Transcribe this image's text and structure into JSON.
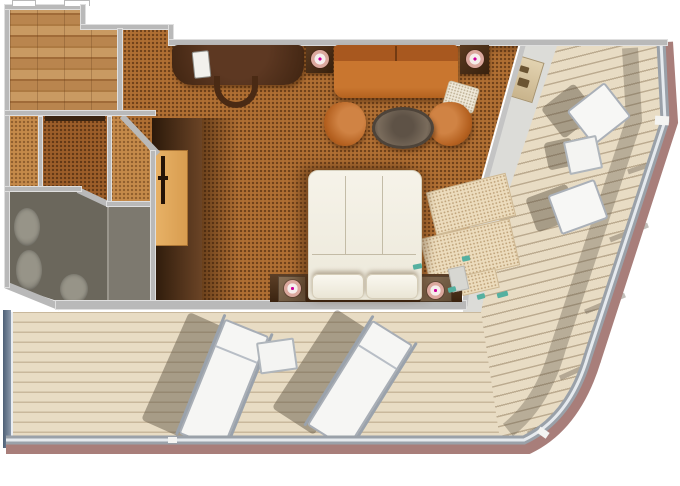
{
  "meta": {
    "kind": "cruise-ship-suite-floor-plan",
    "view": "top-down",
    "text_labels": []
  },
  "palette": {
    "bg": "#ffffff",
    "wall": "#b9b9b9",
    "carpet": "#b06f33",
    "carpet-light": "#c58a4a",
    "carpet-mid": "#9c5e29",
    "bath": "#6b675c",
    "bath-light": "#7d796f",
    "deck-plank": "#e8dcc4",
    "deck-line": "#c9b89c",
    "deck-line2": "#bcab90",
    "walkway": "#dcdcd8",
    "hull-dark": "#4e6076",
    "hull-light": "#8b99ab",
    "railing-gray": "#9aa1a9",
    "railing-highlight": "#e6eaee",
    "railing-mauve": "#a87e7a",
    "rug": "#ecdcbd",
    "teal": "#55b0a0",
    "lamp": "#dba89e",
    "sofa-orange": "#c9762f",
    "bed-white": "#f6f3e9",
    "partition": "#c4c4c4"
  },
  "rooms": [
    {
      "name": "entry-foyer",
      "floor": "wood-planks"
    },
    {
      "name": "walk-in-closet",
      "floor": "carpet"
    },
    {
      "name": "bathroom",
      "floor": "tile"
    },
    {
      "name": "living-area",
      "floor": "carpet"
    },
    {
      "name": "bedroom-area",
      "floor": "carpet"
    },
    {
      "name": "wraparound-balcony",
      "floor": "teak-deck"
    }
  ],
  "furniture": [
    "desk-with-phone",
    "desk-chair",
    "sofa",
    "side-table-lamp-left",
    "side-table-lamp-right",
    "armchair-left",
    "armchair-right",
    "round-coffee-table",
    "queen-bed",
    "bed-pillows",
    "nightstand-left",
    "nightstand-right",
    "vanity-cabinet",
    "wardrobe",
    "bathtub",
    "sink",
    "toilet",
    "balcony-chair-upper",
    "balcony-chair-lower",
    "balcony-side-table",
    "balcony-shelf",
    "sun-lounger-left",
    "sun-lounger-right",
    "deck-table",
    "deck-railing"
  ]
}
